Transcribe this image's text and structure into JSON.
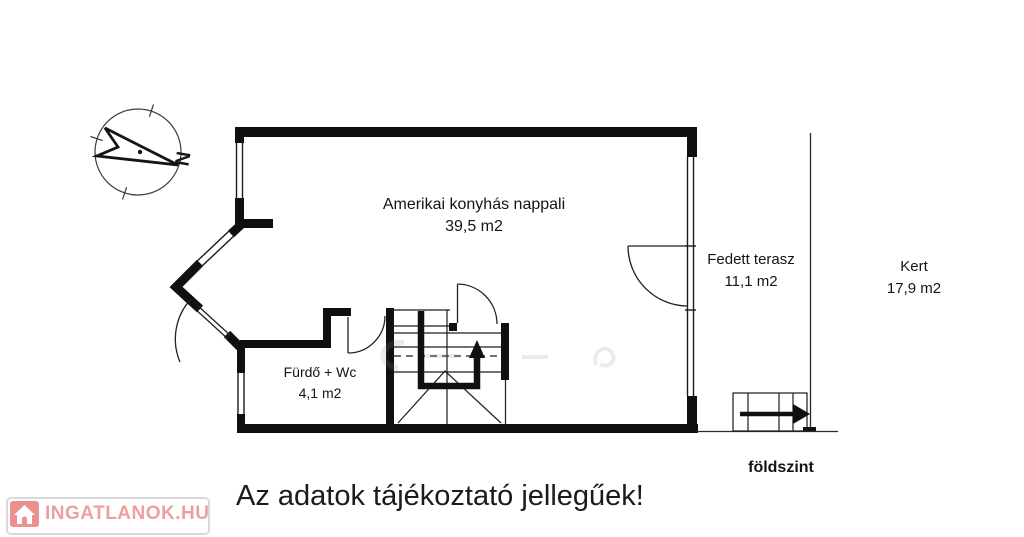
{
  "branding": {
    "logo_text": "INGATLANOK.HU",
    "logo_text_color": "#eda0a0",
    "logo_tile_color": "#ec8f8f"
  },
  "compass": {
    "north_letter": "N"
  },
  "floorplan": {
    "ink_color": "#111111",
    "rooms": [
      {
        "name": "Amerikai konyhás nappali",
        "area": "39,5 m2"
      },
      {
        "name": "Fürdő + Wc",
        "area": "4,1 m2"
      },
      {
        "name": "Fedett terasz",
        "area": "11,1 m2"
      },
      {
        "name": "Kert",
        "area": "17,9 m2"
      }
    ],
    "floor_label": "földszint"
  },
  "disclaimer": "Az adatok tájékoztató jellegűek!"
}
